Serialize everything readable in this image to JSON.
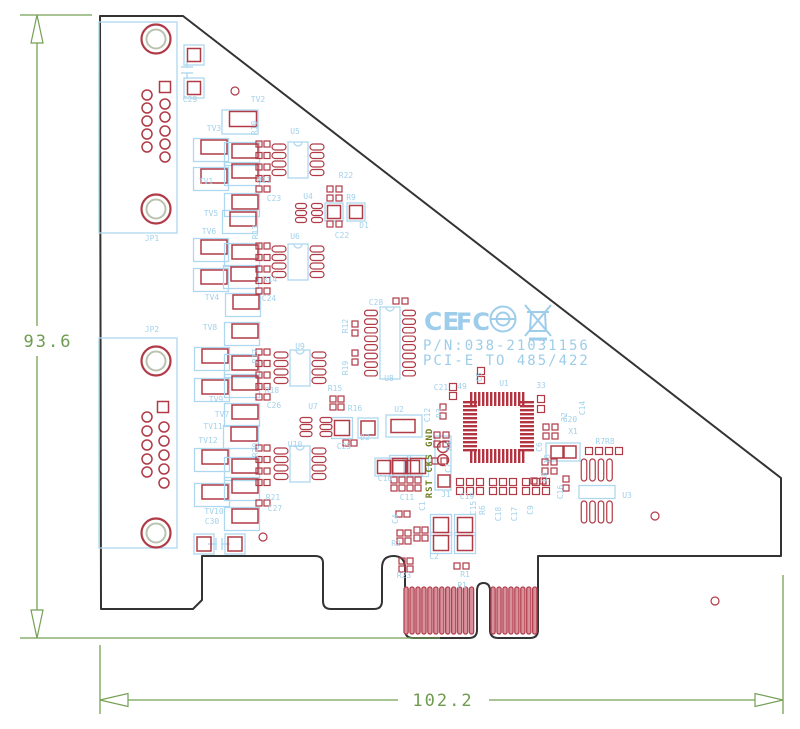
{
  "drawing": {
    "dimension_annotations": {
      "height": "93.6",
      "width": "102.2"
    },
    "board_markings": {
      "part_number": "P/N:038-21031156",
      "model": "PCI-E TO 485/422",
      "header_pins": "RST CKS GND"
    },
    "logos": {
      "ce": "CE",
      "fcc": "FC"
    },
    "colors": {
      "board_outline": "#333333",
      "pad_red": "#b03a46",
      "silkscreen_blue": "#a2d2ec",
      "dimension_green": "#76a054",
      "header_olive": "#6e7d20",
      "finger_pink": "#d8909b"
    }
  },
  "labels": [
    [
      "JP1",
      152,
      241,
      0
    ],
    [
      "C29",
      190,
      102,
      0
    ],
    [
      "TV2",
      258,
      102,
      0
    ],
    [
      "TV3",
      214,
      131,
      0
    ],
    [
      "R10",
      257,
      128,
      1
    ],
    [
      "U5",
      295,
      134,
      0
    ],
    [
      "TV1",
      206,
      184,
      0
    ],
    [
      "R11",
      264,
      183,
      0
    ],
    [
      "R22",
      346,
      178,
      0
    ],
    [
      "TV5",
      211,
      216,
      0
    ],
    [
      "C23",
      274,
      201,
      0
    ],
    [
      "U4",
      308,
      199,
      0
    ],
    [
      "R9",
      351,
      200,
      0
    ],
    [
      "TV6",
      209,
      234,
      0
    ],
    [
      "R13",
      258,
      232,
      1
    ],
    [
      "U6",
      295,
      239,
      0
    ],
    [
      "D1",
      364,
      228,
      0
    ],
    [
      "C22",
      342,
      238,
      0
    ],
    [
      "R14",
      270,
      282,
      0
    ],
    [
      "C24",
      269,
      301,
      0
    ],
    [
      "TV4",
      212,
      300,
      0
    ],
    [
      "TV8",
      210,
      330,
      0
    ],
    [
      "JP2",
      152,
      332,
      0
    ],
    [
      "R17",
      258,
      356,
      1
    ],
    [
      "U9",
      300,
      349,
      0
    ],
    [
      "C28",
      376,
      305,
      0
    ],
    [
      "R12",
      348,
      326,
      1
    ],
    [
      "TV9",
      216,
      402,
      0
    ],
    [
      "R18",
      272,
      393,
      0
    ],
    [
      "R19",
      348,
      368,
      1
    ],
    [
      "TV7",
      222,
      417,
      0
    ],
    [
      "TV11",
      213,
      429,
      0
    ],
    [
      "TV12",
      208,
      443,
      0
    ],
    [
      "R20",
      258,
      450,
      1
    ],
    [
      "U10",
      295,
      447,
      0
    ],
    [
      "U8",
      389,
      381,
      0
    ],
    [
      "R21",
      273,
      500,
      0
    ],
    [
      "C26",
      274,
      408,
      0
    ],
    [
      "C27",
      275,
      511,
      0
    ],
    [
      "TV10",
      214,
      514,
      0
    ],
    [
      "C30",
      212,
      524,
      0
    ],
    [
      "R15",
      335,
      391,
      0
    ],
    [
      "U7",
      313,
      409,
      0
    ],
    [
      "R16",
      355,
      411,
      0
    ],
    [
      "U2",
      399,
      412,
      0
    ],
    [
      "C12",
      430,
      415,
      1
    ],
    [
      "D2",
      365,
      440,
      0
    ],
    [
      "C25",
      344,
      449,
      0
    ],
    [
      "C21",
      441,
      390,
      0
    ],
    [
      "49",
      462,
      389,
      0
    ],
    [
      "U1",
      504,
      386,
      0
    ],
    [
      "33",
      541,
      388,
      0
    ],
    [
      "C5",
      482,
      377,
      1
    ],
    [
      "R3",
      442,
      413,
      1
    ],
    [
      "R4",
      452,
      446,
      1
    ],
    [
      "32",
      567,
      417,
      1
    ],
    [
      "C14",
      585,
      408,
      1
    ],
    [
      "16",
      550,
      459,
      1
    ],
    [
      "C20",
      570,
      422,
      0
    ],
    [
      "X1",
      573,
      434,
      0
    ],
    [
      "C7",
      451,
      468,
      1
    ],
    [
      "C6",
      542,
      447,
      1
    ],
    [
      "C8",
      547,
      477,
      1
    ],
    [
      "C16",
      563,
      492,
      1
    ],
    [
      "J1",
      446,
      497,
      0
    ],
    [
      "C19",
      467,
      499,
      0
    ],
    [
      "C15",
      476,
      508,
      1
    ],
    [
      "R6",
      485,
      510,
      1
    ],
    [
      "C18",
      501,
      514,
      1
    ],
    [
      "C17",
      517,
      514,
      1
    ],
    [
      "C9",
      533,
      510,
      1
    ],
    [
      "C10",
      385,
      481,
      0
    ],
    [
      "C11",
      407,
      500,
      0
    ],
    [
      "C1",
      425,
      506,
      1
    ],
    [
      "C4",
      398,
      519,
      1
    ],
    [
      "R7R8",
      605,
      444,
      0
    ],
    [
      "U3",
      627,
      498,
      0
    ],
    [
      "R2",
      396,
      546,
      0
    ],
    [
      "C2",
      434,
      559,
      0
    ],
    [
      "R23",
      404,
      578,
      0
    ],
    [
      "R1",
      465,
      577,
      0
    ],
    [
      "P1",
      462,
      588,
      0
    ]
  ],
  "geometry": {
    "outline_path": "M100,16 L183,16 L781,478 L781,556 L538,556 L538,630 Q538,638 530,638 L498,638 Q490,638 490,630 L490,591 Q490,583 483.5,583 Q477,583 477,591 L477,630 Q477,638 469,638 L413,638 Q405,638 405,630 L405,568 Q405,556 393.5,556 Q382,556 382,568 L382,601 Q382,609 374,609 L331,609 Q323,609 323,601 L323,563 Q323,556 315,556 L202,556 L202,600 L193,609 L101,609 Z",
    "tv_rects": [
      [
        243,
        119,
        27,
        15
      ],
      [
        214,
        147,
        26,
        14
      ],
      [
        245,
        151,
        26,
        14
      ],
      [
        214,
        176,
        26,
        14
      ],
      [
        245,
        171,
        26,
        14
      ],
      [
        245,
        202,
        26,
        14
      ],
      [
        243,
        219,
        26,
        14
      ],
      [
        214,
        247,
        26,
        14
      ],
      [
        245,
        252,
        26,
        14
      ],
      [
        214,
        277,
        26,
        14
      ],
      [
        244,
        274,
        26,
        14
      ],
      [
        246,
        302,
        26,
        14
      ],
      [
        245,
        331,
        26,
        14
      ],
      [
        215,
        356,
        26,
        14
      ],
      [
        245,
        363,
        26,
        14
      ],
      [
        215,
        387,
        26,
        14
      ],
      [
        245,
        383,
        26,
        14
      ],
      [
        245,
        412,
        26,
        14
      ],
      [
        244,
        434,
        26,
        14
      ],
      [
        215,
        457,
        26,
        14
      ],
      [
        245,
        466,
        26,
        14
      ],
      [
        215,
        492,
        26,
        14
      ],
      [
        245,
        486,
        26,
        14
      ],
      [
        245,
        516,
        26,
        14
      ]
    ],
    "rects": [
      [
        334,
        212,
        13,
        13
      ],
      [
        356,
        212,
        13,
        13
      ],
      [
        342,
        428,
        15,
        15
      ],
      [
        368,
        428,
        14,
        14
      ],
      [
        400,
        466,
        15,
        15
      ],
      [
        418,
        466,
        15,
        15
      ],
      [
        441,
        525,
        15,
        15
      ],
      [
        441,
        543,
        15,
        15
      ],
      [
        465,
        525,
        15,
        15
      ],
      [
        465,
        543,
        15,
        15
      ],
      [
        384,
        467,
        13,
        13
      ],
      [
        399,
        467,
        13,
        13
      ],
      [
        413,
        467,
        13,
        13
      ],
      [
        557,
        452,
        12,
        12
      ],
      [
        570,
        452,
        12,
        12
      ],
      [
        204,
        544,
        14,
        14
      ],
      [
        235,
        544,
        14,
        14
      ],
      [
        194,
        55,
        13,
        13
      ],
      [
        194,
        88,
        13,
        13
      ],
      [
        403,
        426,
        24,
        13
      ],
      [
        444,
        481,
        12,
        12
      ],
      [
        165,
        87,
        11,
        11
      ],
      [
        163,
        407,
        11,
        11
      ]
    ],
    "grids": [
      [
        259,
        144,
        2,
        4,
        8,
        11.5,
        6
      ],
      [
        259,
        189,
        2,
        1,
        8,
        0,
        6
      ],
      [
        330,
        189,
        2,
        2,
        9,
        9,
        6
      ],
      [
        330,
        224,
        2,
        1,
        9,
        0,
        6
      ],
      [
        259,
        246,
        2,
        4,
        8,
        11.5,
        6
      ],
      [
        259,
        291,
        2,
        1,
        8,
        0,
        6
      ],
      [
        259,
        352,
        2,
        4,
        8,
        11.5,
        6
      ],
      [
        259,
        397,
        2,
        1,
        8,
        0,
        6
      ],
      [
        259,
        448,
        2,
        4,
        8,
        11.5,
        6
      ],
      [
        259,
        503,
        2,
        1,
        8,
        0,
        6
      ],
      [
        396,
        301,
        2,
        1,
        9,
        0,
        6
      ],
      [
        355,
        324,
        1,
        2,
        0,
        9,
        6
      ],
      [
        355,
        353,
        1,
        2,
        0,
        9,
        6
      ],
      [
        333,
        399,
        2,
        2,
        8,
        8,
        6
      ],
      [
        346,
        443,
        2,
        1,
        8,
        0,
        6
      ],
      [
        453,
        387,
        1,
        2,
        0,
        9,
        7
      ],
      [
        481,
        371,
        1,
        2,
        0,
        9,
        7
      ],
      [
        443,
        407,
        1,
        2,
        0,
        9,
        6
      ],
      [
        437,
        435,
        2,
        2,
        9,
        9,
        6
      ],
      [
        435,
        461,
        2,
        1,
        9,
        0,
        6
      ],
      [
        541,
        399,
        1,
        2,
        0,
        10,
        7
      ],
      [
        546,
        427,
        2,
        2,
        9,
        9,
        6
      ],
      [
        545,
        462,
        2,
        2,
        9,
        9,
        6
      ],
      [
        534,
        481,
        2,
        1,
        9,
        0,
        6
      ],
      [
        566,
        479,
        1,
        2,
        0,
        9,
        6
      ],
      [
        589,
        451,
        4,
        1,
        10,
        0,
        7
      ],
      [
        460,
        482,
        3,
        2,
        10,
        9,
        7
      ],
      [
        493,
        482,
        3,
        2,
        10,
        9,
        7
      ],
      [
        526,
        482,
        3,
        2,
        10,
        9,
        7
      ],
      [
        394,
        480,
        4,
        2,
        8,
        8,
        6
      ],
      [
        399,
        514,
        2,
        1,
        8,
        0,
        6
      ],
      [
        400,
        533,
        2,
        2,
        8,
        8,
        6
      ],
      [
        417,
        530,
        2,
        2,
        8,
        8,
        6
      ],
      [
        402,
        561,
        2,
        2,
        8,
        8,
        6
      ],
      [
        457,
        566,
        2,
        1,
        9,
        0,
        6
      ]
    ],
    "oval_groups": [
      [
        279,
        147,
        4,
        0,
        8.5,
        14,
        6
      ],
      [
        317,
        147,
        4,
        0,
        8.5,
        14,
        6
      ],
      [
        279,
        249,
        4,
        0,
        8.5,
        14,
        6
      ],
      [
        317,
        249,
        4,
        0,
        8.5,
        14,
        6
      ],
      [
        281,
        355,
        4,
        0,
        8.5,
        14,
        6
      ],
      [
        319,
        355,
        4,
        0,
        8.5,
        14,
        6
      ],
      [
        281,
        451,
        4,
        0,
        8.5,
        14,
        6
      ],
      [
        319,
        451,
        4,
        0,
        8.5,
        14,
        6
      ],
      [
        371,
        313,
        8,
        0,
        8.6,
        13,
        5.5
      ],
      [
        409,
        313,
        8,
        0,
        8.6,
        13,
        5.5
      ],
      [
        301,
        206,
        3,
        0,
        7,
        11,
        5
      ],
      [
        317,
        206,
        3,
        0,
        7,
        11,
        5
      ],
      [
        306,
        420,
        3,
        0,
        7,
        12,
        5
      ],
      [
        326,
        420,
        3,
        0,
        7,
        12,
        5
      ],
      [
        584,
        470,
        4,
        8.5,
        0,
        5.5,
        22
      ],
      [
        584,
        512,
        4,
        8.5,
        0,
        5.5,
        22
      ]
    ],
    "ic_bodies": [
      [
        298,
        160,
        20,
        36
      ],
      [
        298,
        262,
        20,
        36
      ],
      [
        300,
        368,
        20,
        36
      ],
      [
        300,
        464,
        20,
        36
      ],
      [
        390,
        343,
        20,
        72
      ]
    ],
    "blue_boxes": [
      [
        138,
        127.5,
        78,
        211
      ],
      [
        138,
        443,
        78,
        210
      ],
      [
        194,
        55,
        20,
        20
      ],
      [
        194,
        88,
        20,
        20
      ],
      [
        204,
        544,
        20,
        20
      ],
      [
        235,
        544,
        20,
        20
      ],
      [
        443,
        463,
        16,
        54
      ],
      [
        400,
        466,
        21,
        21
      ],
      [
        418,
        466,
        21,
        21
      ],
      [
        441,
        525,
        21,
        21
      ],
      [
        441,
        543,
        21,
        21
      ],
      [
        465,
        525,
        21,
        21
      ],
      [
        465,
        543,
        21,
        21
      ],
      [
        342,
        428,
        21,
        21
      ],
      [
        368,
        428,
        20,
        20
      ],
      [
        384,
        467,
        18,
        18
      ],
      [
        399,
        467,
        18,
        18
      ],
      [
        413,
        467,
        18,
        18
      ],
      [
        334,
        212,
        18,
        18
      ],
      [
        356,
        212,
        18,
        18
      ],
      [
        563,
        452,
        34,
        18
      ],
      [
        404,
        426,
        36,
        22
      ],
      [
        597,
        492,
        36,
        13
      ]
    ],
    "silk_lines": [
      [
        181,
        67,
        193,
        67
      ],
      [
        181,
        73,
        193,
        73
      ],
      [
        187,
        61,
        187,
        67
      ],
      [
        187,
        73,
        187,
        79
      ],
      [
        216,
        538,
        216,
        550
      ],
      [
        222,
        538,
        222,
        550
      ],
      [
        208,
        544,
        216,
        544
      ],
      [
        222,
        544,
        230,
        544
      ]
    ],
    "mount_holes": [
      [
        156,
        39
      ],
      [
        156,
        209
      ],
      [
        156,
        361
      ],
      [
        156,
        533
      ]
    ],
    "small_holes": [
      [
        235,
        91
      ],
      [
        263,
        537
      ],
      [
        655,
        516
      ],
      [
        715,
        601
      ]
    ],
    "dsub_circles": [
      [
        165,
        104
      ],
      [
        165,
        117
      ],
      [
        165,
        131
      ],
      [
        165,
        144
      ],
      [
        165,
        157
      ],
      [
        147,
        95
      ],
      [
        147,
        108
      ],
      [
        147,
        121
      ],
      [
        147,
        134
      ],
      [
        147,
        147
      ],
      [
        164,
        427
      ],
      [
        164,
        441
      ],
      [
        164,
        455
      ],
      [
        164,
        469
      ],
      [
        164,
        483
      ],
      [
        147,
        417
      ],
      [
        147,
        431
      ],
      [
        147,
        445
      ],
      [
        147,
        459
      ],
      [
        147,
        472
      ]
    ],
    "j1_circles": [
      [
        443,
        447
      ],
      [
        443,
        460
      ]
    ],
    "qfp_strips": [
      [
        470,
        392,
        57,
        14,
        "v"
      ],
      [
        470,
        449,
        57,
        14,
        "v"
      ],
      [
        463,
        401,
        14,
        53,
        "h"
      ],
      [
        520,
        401,
        14,
        53,
        "h"
      ]
    ],
    "fingers": [
      [
        404,
        587,
        12,
        5.95,
        4.2,
        47
      ],
      [
        491,
        587,
        8,
        5.95,
        4.2,
        47
      ]
    ],
    "dim_lines": [
      [
        20,
        15,
        92,
        15
      ],
      [
        20,
        638,
        440,
        638
      ],
      [
        37,
        15,
        37,
        326
      ],
      [
        37,
        356,
        37,
        638
      ],
      [
        100,
        645,
        100,
        714
      ],
      [
        783,
        575,
        783,
        714
      ],
      [
        100,
        700,
        398,
        700
      ],
      [
        489,
        700,
        783,
        700
      ]
    ],
    "dim_arrows": [
      [
        37,
        15,
        "up"
      ],
      [
        37,
        638,
        "down"
      ],
      [
        100,
        700,
        "left"
      ],
      [
        783,
        700,
        "right"
      ]
    ]
  }
}
